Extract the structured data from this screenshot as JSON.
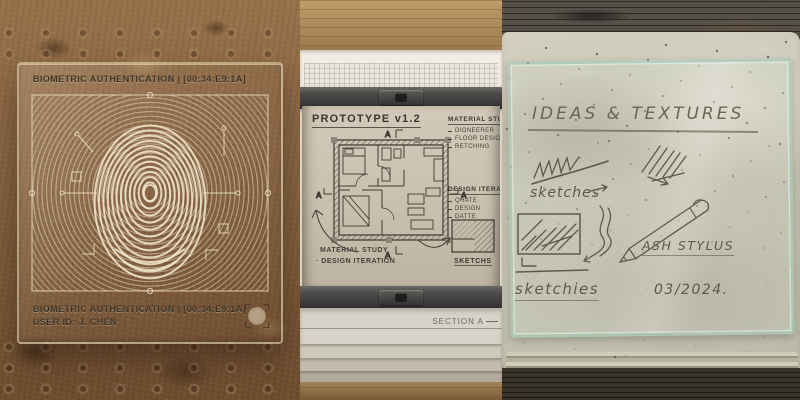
{
  "panels": {
    "biometric": {
      "header": "BIOMETRIC AUTHENTICATION | [00:34:E9:1A]",
      "footer_auth": "BIOMETRIC AUTHENTICATION | [00:34:E9:1A]",
      "footer_user": "USER ID: J. CHEN"
    },
    "blueprint": {
      "title": "PROTOTYPE v1.2",
      "section_marker": "A",
      "material_study": {
        "heading": "MATERIAL STUDY",
        "items": [
          "DIONEERER",
          "FLOOR DESIGN",
          "RETCHING"
        ]
      },
      "design_iteration": {
        "heading": "DESIGN ITERATION",
        "items": [
          "QHATE",
          "DESIGN",
          "DATTE"
        ]
      },
      "note_material": "MATERIAL STUDY",
      "note_design": "· DESIGN ITERATION",
      "sketch_label": "SKETCHS",
      "section_label": "SECTION A"
    },
    "journal": {
      "title": "IDEAS & TEXTURES",
      "sketches_label": "sketches",
      "sketchies_label": "sketchies",
      "stylus_label": "ASH STYLUS",
      "date_label": "03/2024."
    },
    "colors": {
      "dirt_brown": "#8a6747",
      "etch_cream": "#e8dcc2",
      "sheet_beige": "#c9c0ae",
      "rail_gray": "#4b4a48",
      "glass_green": "#9ec7b2",
      "pencil_gray": "#5f594c",
      "ink_dark": "#3b3831"
    }
  }
}
